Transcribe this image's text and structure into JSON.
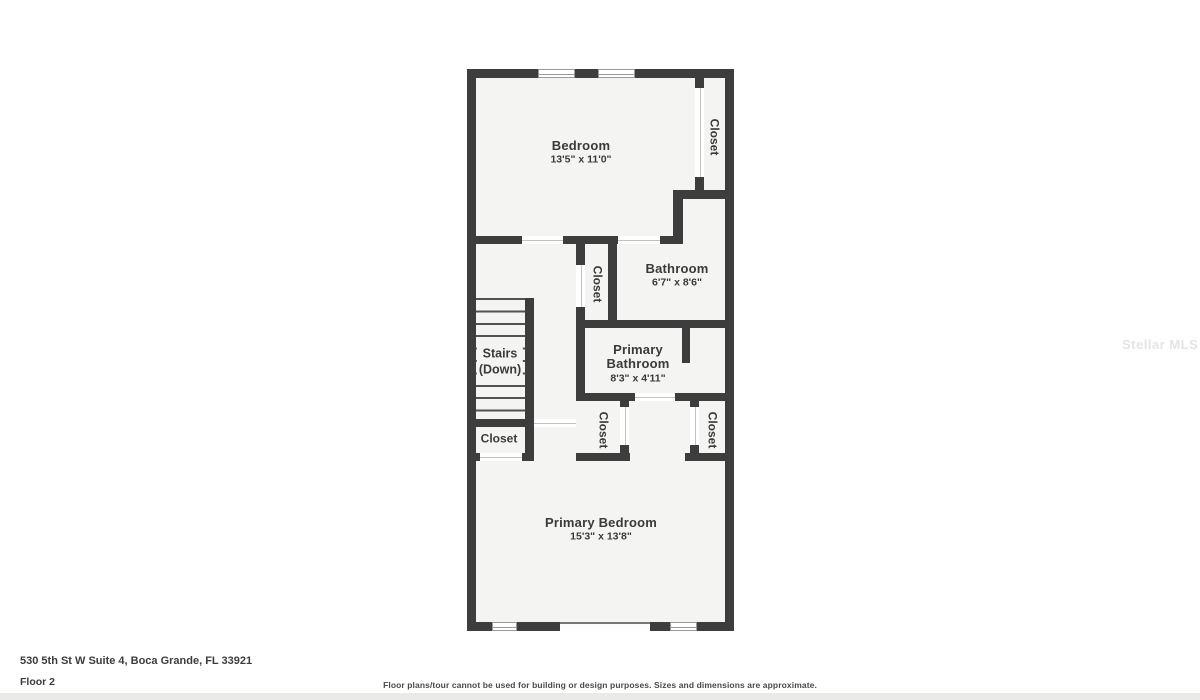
{
  "plan": {
    "bedroom": {
      "name": "Bedroom",
      "dims": "13'5\" x 11'0\""
    },
    "closet_top_right": {
      "name": "Closet"
    },
    "bathroom": {
      "name": "Bathroom",
      "dims": "6'7\" x 8'6\""
    },
    "hall_closet": {
      "name": "Closet"
    },
    "primary_bathroom": {
      "name_line1": "Primary",
      "name_line2": "Bathroom",
      "dims": "8'3\" x 4'11\""
    },
    "stairs": {
      "line1": "Stairs",
      "line2": "(Down)"
    },
    "closet_under_stairs": {
      "name": "Closet"
    },
    "closet_lower_left": {
      "name": "Closet"
    },
    "closet_lower_right": {
      "name": "Closet"
    },
    "primary_bedroom": {
      "name": "Primary Bedroom",
      "dims": "15'3\" x 13'8\""
    }
  },
  "footer": {
    "address": "530 5th St W Suite 4, Boca Grande, FL 33921",
    "floor": "Floor 2",
    "disclaimer": "Floor plans/tour cannot be used for building or design purposes. Sizes and dimensions are approximate."
  },
  "watermark": "Stellar MLS",
  "colors": {
    "wall": "#3d3d3d",
    "room_fill": "#f4f4f2",
    "background": "#ffffff"
  }
}
